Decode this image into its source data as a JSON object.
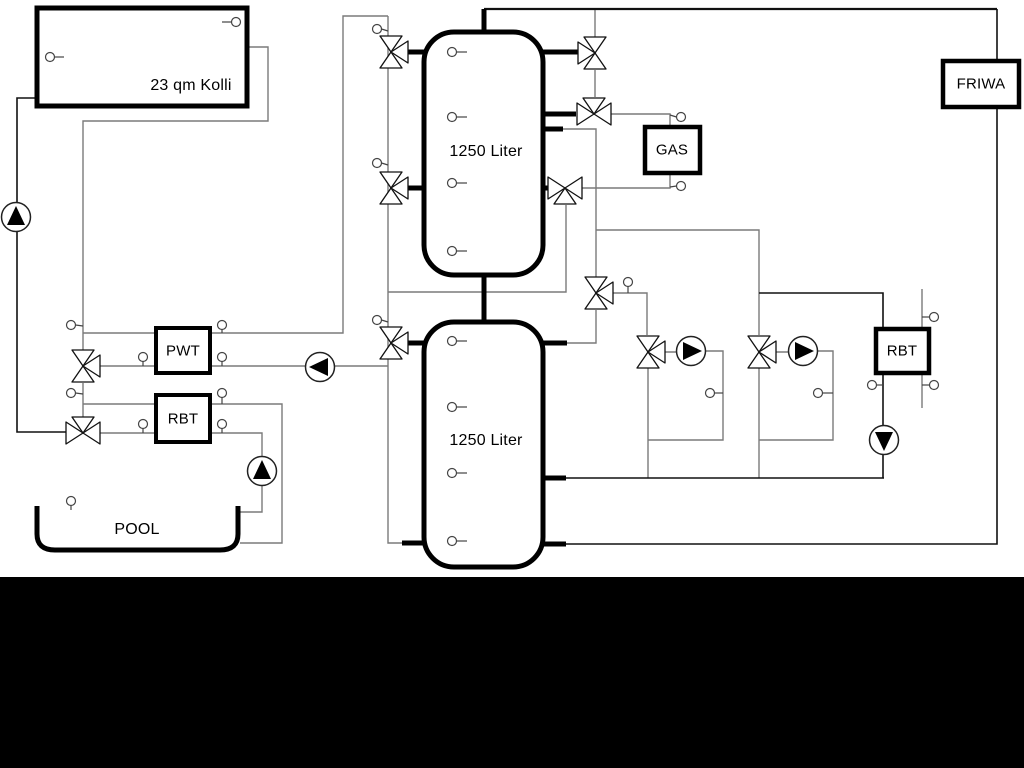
{
  "diagram": {
    "title": "hydraulic-scheme",
    "labels": {
      "collector": "23 qm Kolli",
      "tank_top": "1250 Liter",
      "tank_bottom": "1250 Liter",
      "pwt": "PWT",
      "rbt_left": "RBT",
      "gas": "GAS",
      "friwa": "FRIWA",
      "rbt_right": "RBT",
      "pool": "POOL"
    },
    "colors": {
      "background": "#ffffff",
      "pipe_gray": "#7a7a7a",
      "pipe_dark": "#111111",
      "outline_black": "#000000",
      "bottom_band": "#000000"
    }
  }
}
